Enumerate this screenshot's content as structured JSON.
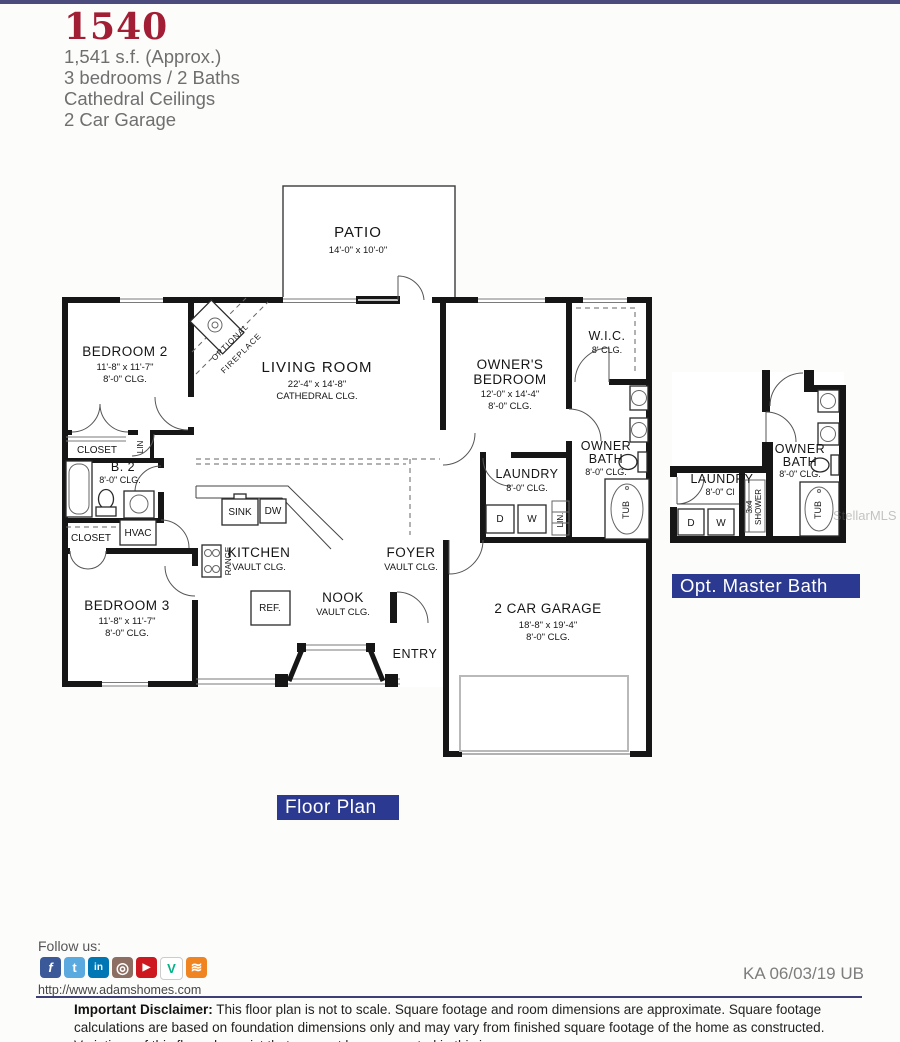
{
  "header": {
    "model_number": "1540",
    "specs": [
      "1,541 s.f. (Approx.)",
      "3 bedrooms / 2 Baths",
      "Cathedral Ceilings",
      "2 Car Garage"
    ],
    "accent_color": "#a21e35"
  },
  "plan": {
    "label_bg_color": "#2b3990",
    "floor_label": "Floor Plan",
    "patio": {
      "name": "PATIO",
      "dims": "14'-0\" x 10'-0\""
    },
    "living": {
      "name": "LIVING ROOM",
      "dims": "22'-4\" x 14'-8\"",
      "clg": "CATHEDRAL CLG."
    },
    "fire": {
      "l1": "OPTIONAL",
      "l2": "FIREPLACE"
    },
    "bed2": {
      "name": "BEDROOM 2",
      "dims": "11'-8\" x 11'-7\"",
      "clg": "8'-0\" CLG."
    },
    "bed3": {
      "name": "BEDROOM 3",
      "dims": "11'-8\" x 11'-7\"",
      "clg": "8'-0\" CLG."
    },
    "owners": {
      "n1": "OWNER'S",
      "n2": "BEDROOM",
      "dims": "12'-0\" x 14'-4\"",
      "clg": "8'-0\" CLG."
    },
    "wic": {
      "name": "W.I.C.",
      "clg": "8' CLG."
    },
    "obath": {
      "n1": "OWNER",
      "n2": "BATH",
      "clg": "8'-0\" CLG.",
      "tub": "TUB"
    },
    "b2": {
      "name": "B. 2",
      "clg": "8'-0\" CLG."
    },
    "laundry": {
      "name": "LAUNDRY",
      "clg": "8'-0\" CLG.",
      "d": "D",
      "w": "W",
      "lin": "LIN."
    },
    "kitchen": {
      "name": "KITCHEN",
      "clg": "VAULT CLG.",
      "sink": "SINK",
      "dw": "DW",
      "range": "RANGE",
      "ref": "REF."
    },
    "nook": {
      "name": "NOOK",
      "clg": "VAULT CLG."
    },
    "foyer": {
      "name": "FOYER",
      "clg": "VAULT CLG."
    },
    "entry": "ENTRY",
    "garage": {
      "name": "2 CAR GARAGE",
      "dims": "18'-8\" x 19'-4\"",
      "clg": "8'-0\" CLG."
    },
    "closet1": "CLOSET",
    "closet2": "CLOSET",
    "lin": "LIN",
    "hvac": "HVAC",
    "opt": {
      "label": "Opt. Master Bath",
      "laundry": "LAUNDRY",
      "laundry_clg": "8'-0\" Cl",
      "d": "D",
      "w": "W",
      "shower1": "3x4",
      "shower2": "SHOWER",
      "n1": "OWNER",
      "n2": "BATH",
      "clg": "8'-0\" CLG.",
      "tub": "TUB"
    }
  },
  "watermark": "StellarMLS",
  "footer": {
    "follow": "Follow us:",
    "url": "http://www.adamshomes.com",
    "revision": "KA 06/03/19 UB",
    "social": [
      {
        "name": "facebook",
        "glyph": "f",
        "style": "background:#3b5998;color:#fff;font-style:italic"
      },
      {
        "name": "twitter",
        "glyph": "t",
        "style": "background:#5aaae0;color:#fff"
      },
      {
        "name": "linkedin",
        "glyph": "in",
        "style": "background:#0077b5;color:#fff;font-size:10px"
      },
      {
        "name": "instagram",
        "glyph": "◎",
        "style": "background:#8d6e63;color:#fff;font-size:15px"
      },
      {
        "name": "youtube",
        "glyph": "▶",
        "style": "background:#cc181e;color:#fff;font-size:10px"
      },
      {
        "name": "vine",
        "glyph": "V",
        "style": "background:#fff;color:#00b488;border:1px solid #ccc"
      },
      {
        "name": "rss",
        "glyph": "≋",
        "style": "background:#f08421;color:#fff;font-size:14px"
      }
    ],
    "disclaimer_bold": "Important Disclaimer:",
    "disclaimer_text": " This floor plan is not to scale. Square footage and room dimensions are approximate. Square footage calculations are based on foundation dimensions only and may vary from finished square footage of the home as constructed. Variations of this floor plan exist that may not be represented in this image."
  }
}
